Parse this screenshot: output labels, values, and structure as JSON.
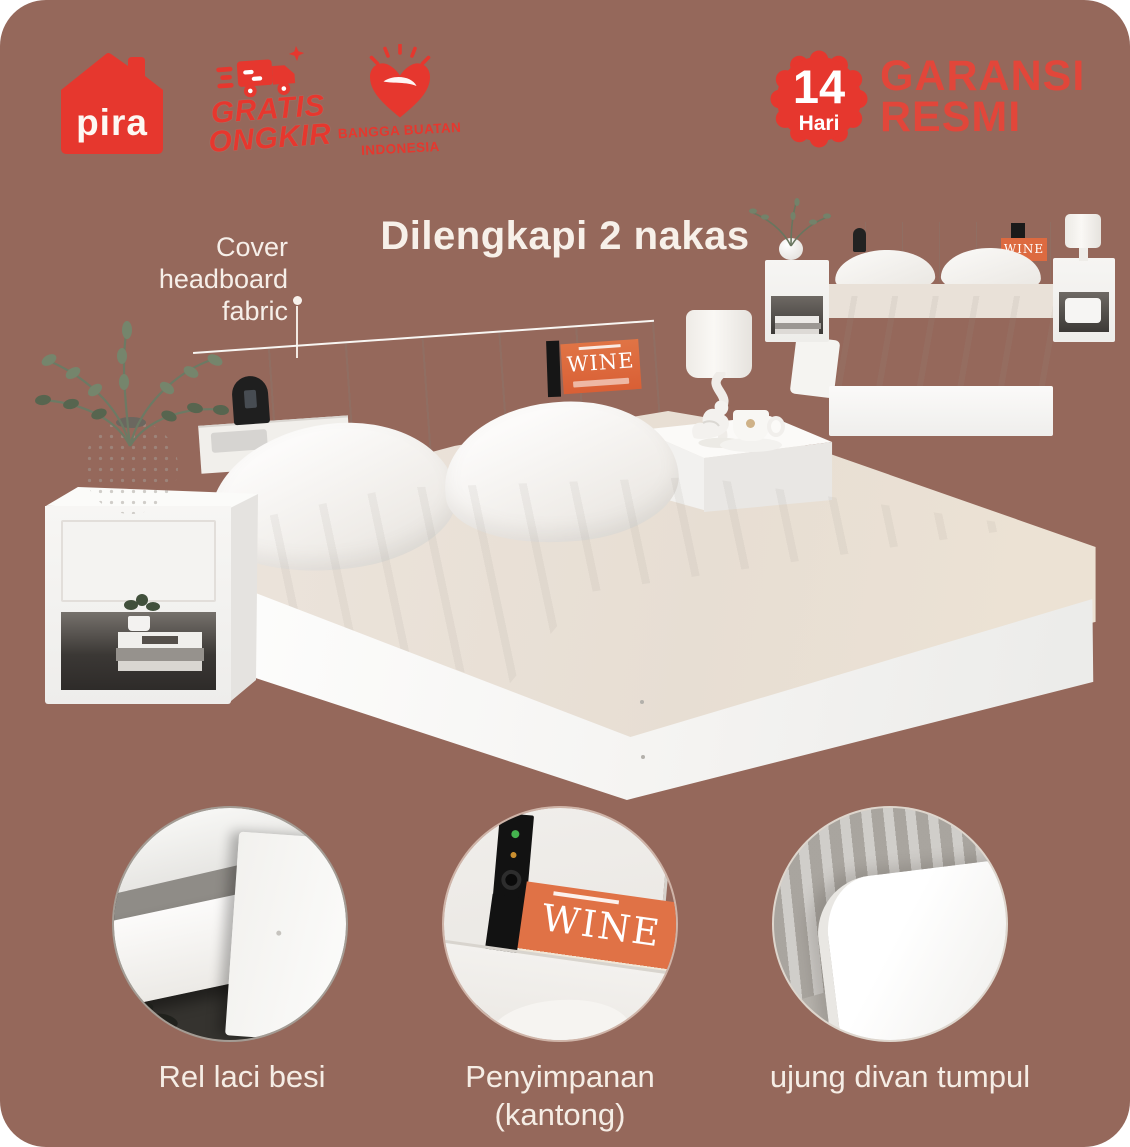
{
  "header": {
    "brand": {
      "name": "pira"
    },
    "free_shipping": {
      "line1": "GRATIS",
      "line2": "ONGKIR"
    },
    "made_in": {
      "line1": "BANGGA BUATAN",
      "line2": "INDONESIA"
    },
    "warranty": {
      "number": "14",
      "unit": "Hari",
      "line1": "GARANSI",
      "line2": "RESMI"
    }
  },
  "hero": {
    "headline": "Dilengkapi 2 nakas",
    "annotation": {
      "line1": "Cover",
      "line2": "headboard",
      "line3": "fabric"
    },
    "headboard_magazine_title": "WINE"
  },
  "inset": {
    "magazine_title": "WINE"
  },
  "callouts": {
    "drawer": {
      "label": "Rel laci besi"
    },
    "storage": {
      "label_line1": "Penyimpanan",
      "label_line2": "(kantong)",
      "magazine_title": "WINE",
      "magazine_issue": "220"
    },
    "edge": {
      "label": "ujung divan tumpul"
    }
  },
  "colors": {
    "background_brown": "#95685b",
    "accent_red": "#e6372e",
    "text_red": "#e2463a",
    "text_cream": "#f6efe8",
    "magazine_orange": "#dd6a40"
  }
}
